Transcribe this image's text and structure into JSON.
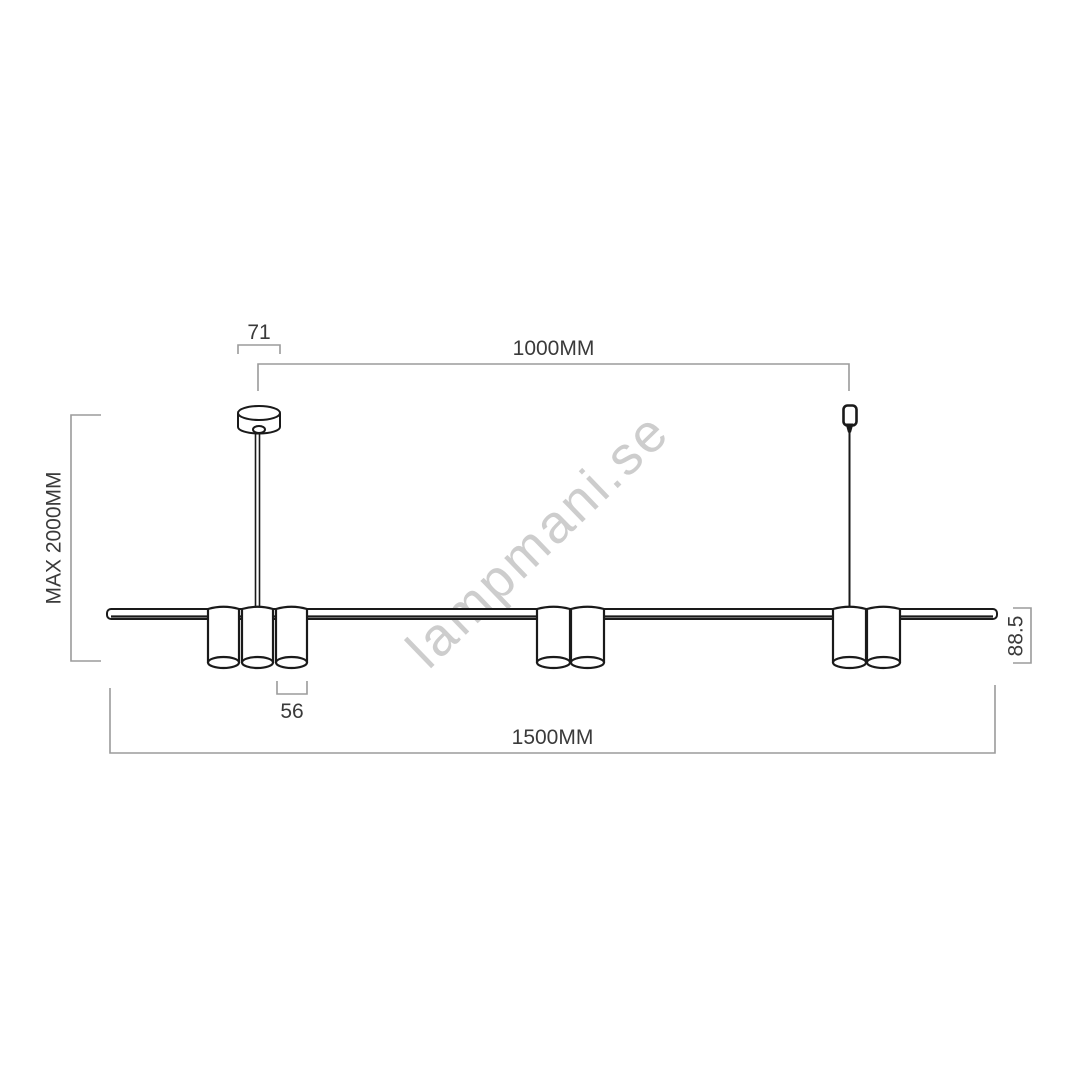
{
  "figure": {
    "type": "technical dimension drawing",
    "subject": "linear pendant lamp with cylindrical spot shades, ceiling canopy and suspension cords"
  },
  "watermark": {
    "text": "lampmani.se"
  },
  "labels": {
    "canopy_width": "71",
    "suspension_spacing": "1000MM",
    "max_height": "MAX 2000MM",
    "shade_diameter": "56",
    "total_length": "1500MM",
    "bar_height": "88.5"
  },
  "colors": {
    "outline": "#1a1a1a",
    "dimension_line": "#9b9b9b",
    "label_text": "#3a3a3a",
    "watermark": "#cdcdcd",
    "background": "#ffffff"
  }
}
